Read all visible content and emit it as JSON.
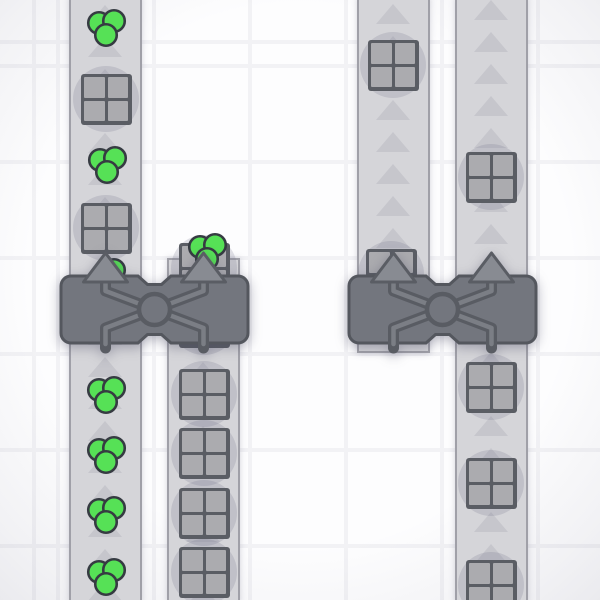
{
  "scene": {
    "description": "factory-game top-down view with conveyor belts, balancer machines, crate items and green circle items",
    "colors": {
      "bg_cell": "#fdfdfe",
      "grid_line": "#f2f2f5",
      "belt_fill": "#d5d5d9",
      "belt_edge": "#a0a0a8",
      "belt_arrow": "#c6c6cc",
      "item_disc": "rgba(110,110,135,0.20)",
      "crate_frame": "#5a5d64",
      "crate_cell": "#ababaf",
      "green_fill": "#56e156",
      "green_stroke": "#363b42",
      "bal_fill": "#73767e",
      "bal_stroke": "#54575e",
      "pipe_dark": "#595c63",
      "pipe_light": "#7b7e85",
      "in_arrow_fill": "#888b92",
      "in_arrow_stroke": "#5a5d64"
    },
    "grid": {
      "spacing": 96,
      "line_width": 4,
      "offset_x": 58,
      "offset_y": 66
    },
    "arrow": {
      "spacing": 32,
      "width": 34,
      "height": 20
    },
    "belts": [
      {
        "id": "belt-a",
        "x": 69,
        "width": 73,
        "top": -3,
        "bottom": 603,
        "edge_top": false,
        "edge_bottom": false,
        "arrow_start": 5,
        "arrow_end": 600
      },
      {
        "id": "belt-b",
        "x": 167,
        "width": 73,
        "top": 258,
        "bottom": 603,
        "edge_top": true,
        "edge_bottom": false,
        "arrow_start": 360,
        "arrow_end": 600
      },
      {
        "id": "belt-c",
        "x": 357,
        "width": 73,
        "top": -3,
        "bottom": 353,
        "edge_top": false,
        "edge_bottom": true,
        "arrow_start": 4,
        "arrow_end": 242
      },
      {
        "id": "belt-d",
        "x": 455,
        "width": 73,
        "top": -3,
        "bottom": 603,
        "edge_top": false,
        "edge_bottom": false,
        "arrow_start": 0,
        "arrow_end": 600
      }
    ],
    "items": [
      {
        "type": "green-triple",
        "x": 105,
        "y": 28
      },
      {
        "type": "crate",
        "x": 106,
        "y": 99
      },
      {
        "type": "green-triple",
        "x": 106,
        "y": 165
      },
      {
        "type": "crate",
        "x": 106,
        "y": 228
      },
      {
        "type": "green-single",
        "x": 114,
        "y": 270
      },
      {
        "type": "crate",
        "x": 204,
        "y": 268
      },
      {
        "type": "crate",
        "x": 204,
        "y": 322
      },
      {
        "type": "green-triple",
        "x": 206,
        "y": 252
      },
      {
        "type": "crate",
        "x": 391,
        "y": 274
      },
      {
        "type": "green-triple",
        "x": 105,
        "y": 395
      },
      {
        "type": "green-triple",
        "x": 105,
        "y": 455
      },
      {
        "type": "green-triple",
        "x": 105,
        "y": 515
      },
      {
        "type": "green-triple",
        "x": 105,
        "y": 577
      },
      {
        "type": "crate",
        "x": 204,
        "y": 394
      },
      {
        "type": "crate",
        "x": 204,
        "y": 453
      },
      {
        "type": "crate",
        "x": 204,
        "y": 513
      },
      {
        "type": "crate",
        "x": 204,
        "y": 572
      },
      {
        "type": "crate",
        "x": 393,
        "y": 65
      },
      {
        "type": "crate",
        "x": 491,
        "y": 177
      },
      {
        "type": "crate",
        "x": 491,
        "y": 387
      },
      {
        "type": "crate",
        "x": 491,
        "y": 483
      },
      {
        "type": "crate",
        "x": 491,
        "y": 585
      }
    ],
    "balancers": [
      {
        "id": "balancer-left",
        "x": 60,
        "y": 248,
        "width": 189,
        "inputs_local": [
          45.5,
          143.5
        ]
      },
      {
        "id": "balancer-right",
        "x": 348,
        "y": 248,
        "width": 189,
        "inputs_local": [
          45.5,
          143.5
        ]
      }
    ]
  }
}
